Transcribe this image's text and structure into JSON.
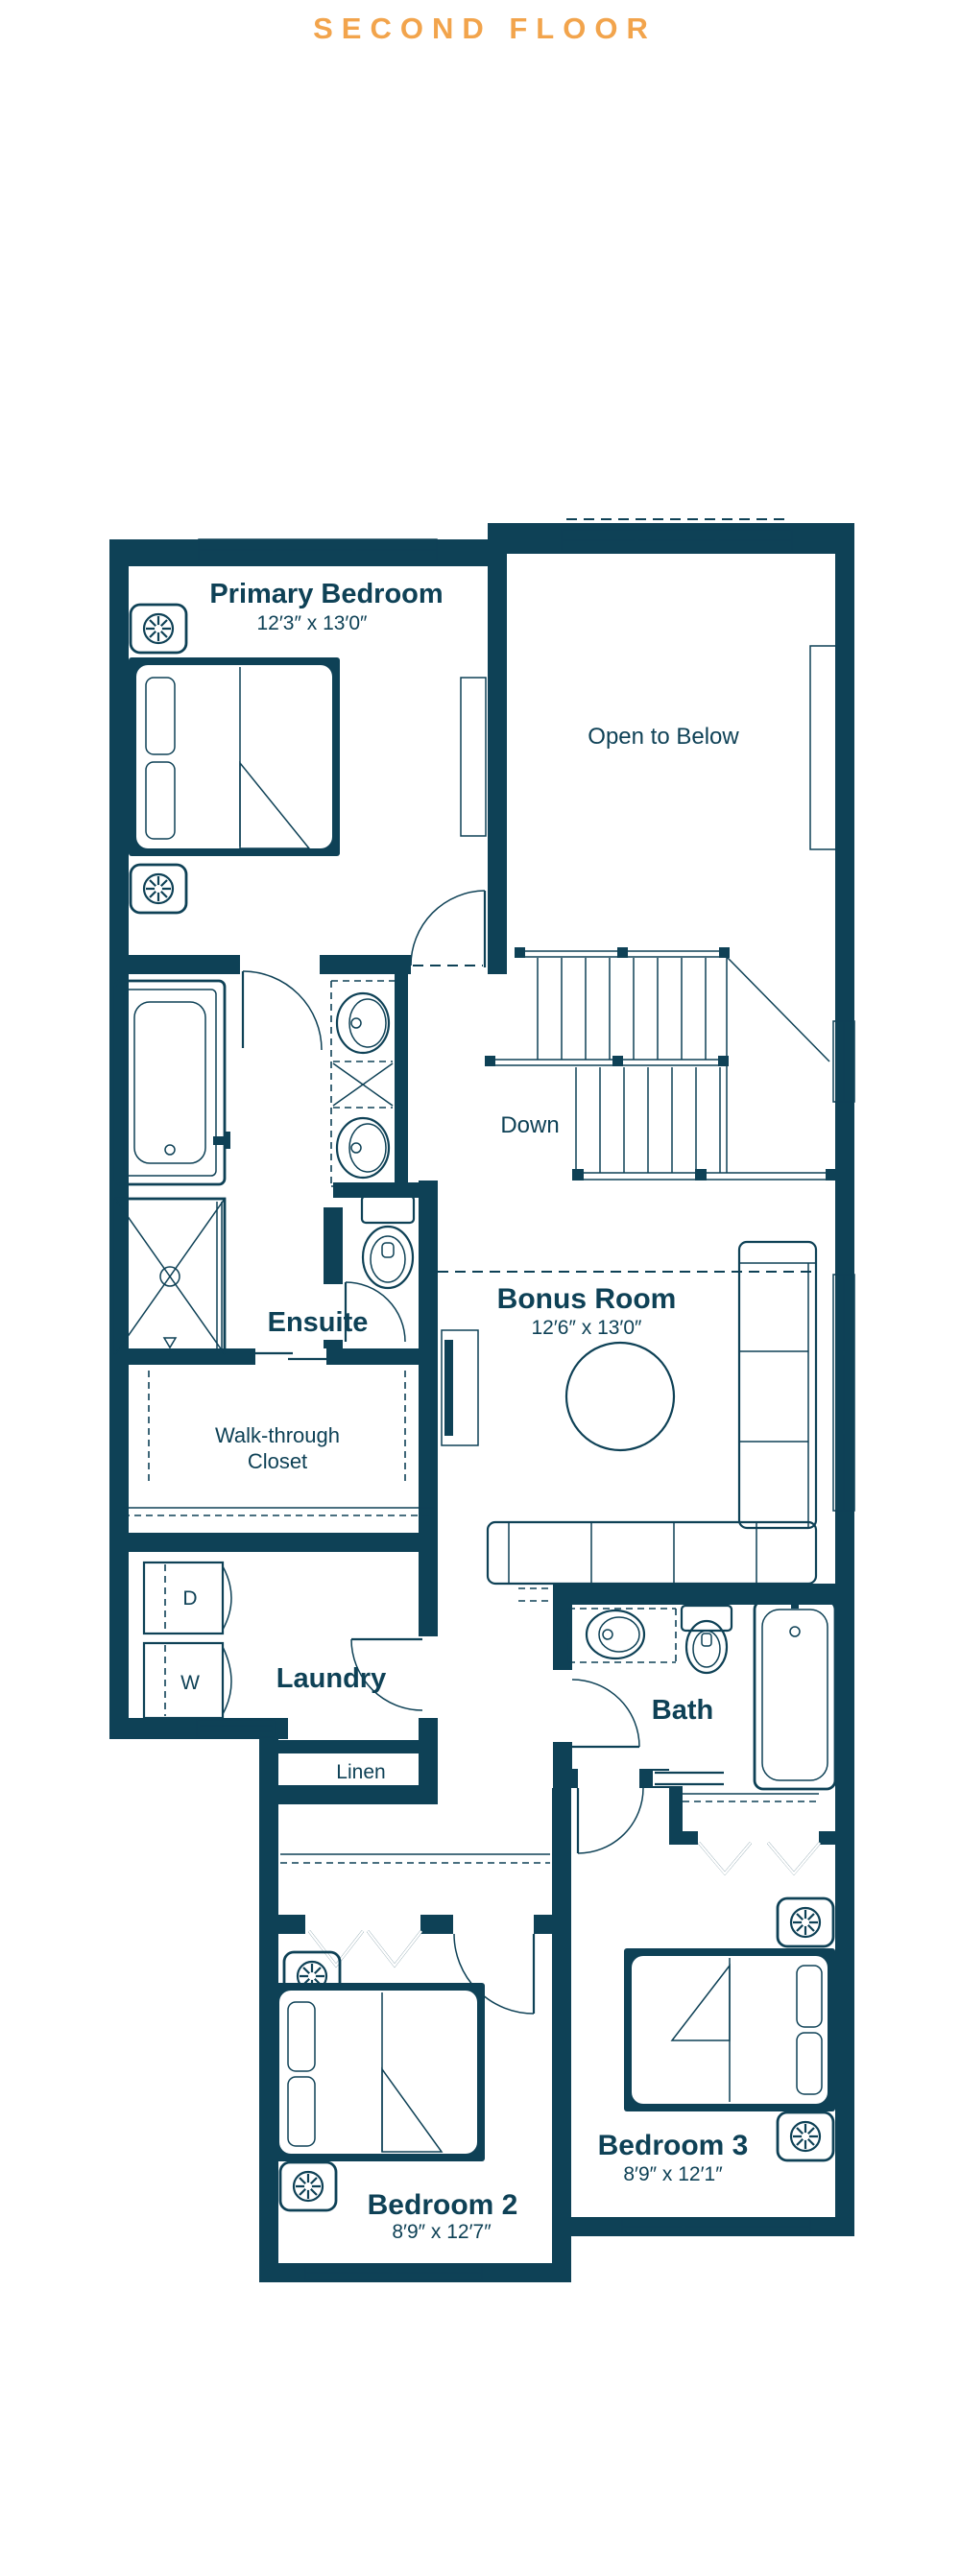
{
  "title": "SECOND FLOOR",
  "colors": {
    "wall": "#0e4156",
    "accent": "#f2a44c",
    "background": "#ffffff"
  },
  "rooms": {
    "primary_bedroom": {
      "name": "Primary Bedroom",
      "dims": "12′3″ x 13′0″"
    },
    "open_to_below": {
      "name": "Open to Below"
    },
    "stairs": {
      "label": "Down"
    },
    "ensuite": {
      "name": "Ensuite"
    },
    "walk_through_closet": {
      "name_line1": "Walk-through",
      "name_line2": "Closet"
    },
    "bonus_room": {
      "name": "Bonus Room",
      "dims": "12′6″ x 13′0″"
    },
    "laundry": {
      "name": "Laundry",
      "dryer_label": "D",
      "washer_label": "W"
    },
    "linen": {
      "name": "Linen"
    },
    "bath": {
      "name": "Bath"
    },
    "bedroom_2": {
      "name": "Bedroom 2",
      "dims": "8′9″ x 12′7″"
    },
    "bedroom_3": {
      "name": "Bedroom 3",
      "dims": "8′9″ x 12′1″"
    }
  }
}
